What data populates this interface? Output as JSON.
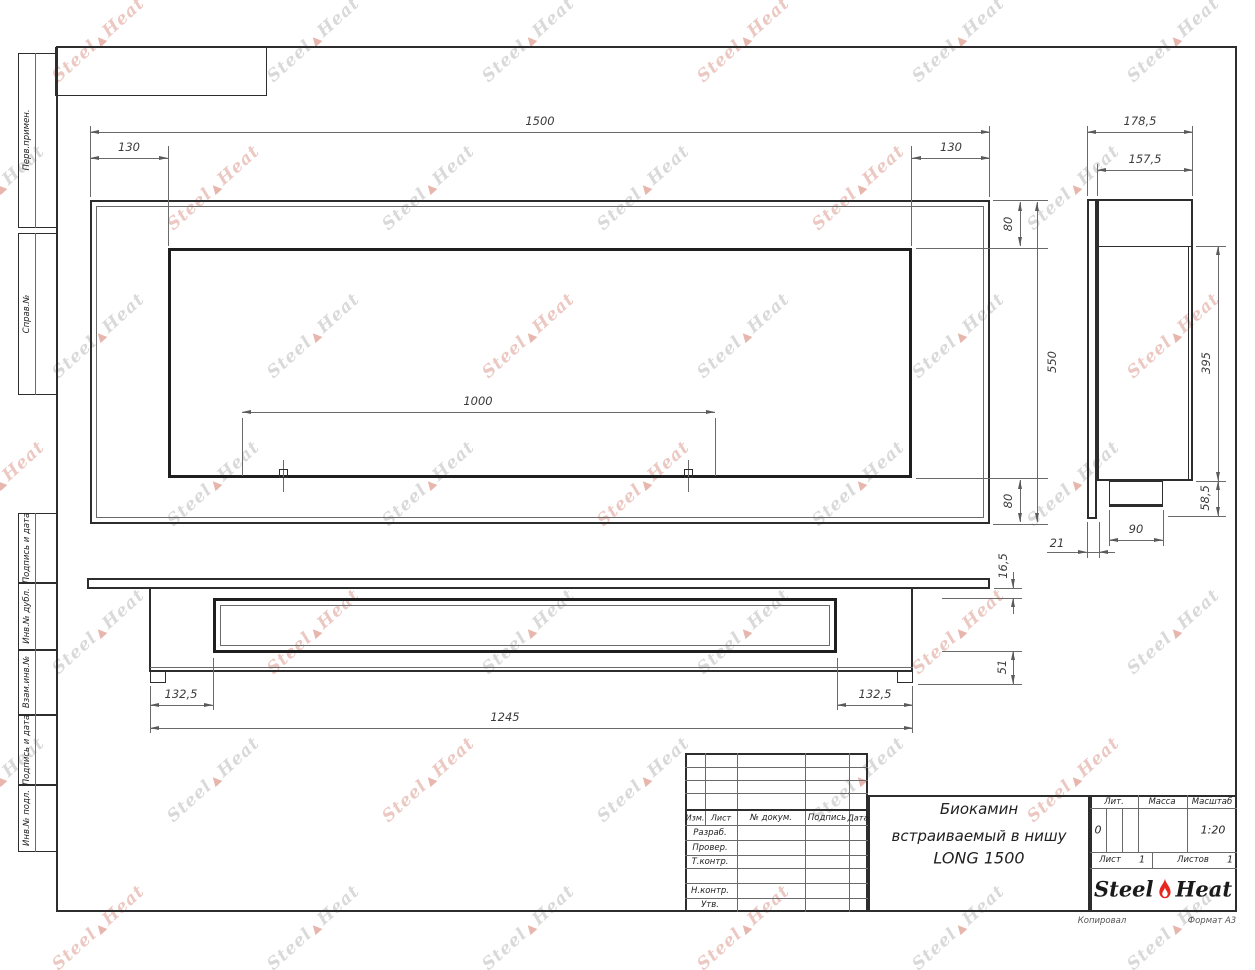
{
  "document": {
    "type": "engineering-drawing",
    "standard": "GOST title block",
    "title_line1": "Биокамин",
    "title_line2": "встраиваемый в нишу",
    "title_line3": "LONG 1500"
  },
  "sidebar": {
    "items": [
      "Перв.примен.",
      "Справ.№",
      "Подпись и дата",
      "Инв.№ дубл.",
      "Взам.инв.№",
      "Подпись и дата",
      "Инв.№ подл."
    ]
  },
  "title_block": {
    "revision_columns": [
      "Изм.",
      "Лист",
      "№ докум.",
      "Подпись",
      "Дата"
    ],
    "roles": [
      "Разраб.",
      "Провер.",
      "Т.контр.",
      "Н.контр.",
      "Утв."
    ],
    "lit_label": "Лит.",
    "lit_value": "0",
    "mass_label": "Масса",
    "scale_label": "Масштаб",
    "scale_value": "1:20",
    "sheet_label": "Лист",
    "sheet_value": "1",
    "sheets_label": "Листов",
    "sheets_value": "1",
    "brand_word1": "Steel",
    "brand_word2": "Heat",
    "copied_by": "Копировал",
    "format": "Формат А3"
  },
  "views": {
    "front": {
      "dim_total_width": "1500",
      "dim_inset_left": "130",
      "dim_inset_right": "130",
      "dim_top_offset": "80",
      "dim_total_height": "550",
      "dim_bottom_offset": "80",
      "dim_bracket_span": "1000"
    },
    "side": {
      "dim_total_depth": "178,5",
      "dim_body_depth": "157,5",
      "dim_niche_height": "395",
      "dim_bottom_lip": "58,5",
      "dim_burner_width": "90",
      "dim_plate_offset": "21"
    },
    "bottom": {
      "dim_plate_thickness": "16,5",
      "dim_tray_depth": "51",
      "dim_inset_left": "132,5",
      "dim_body_length": "1245",
      "dim_inset_right": "132,5"
    }
  },
  "watermark": {
    "word1": "Steel",
    "word2": "Heat"
  },
  "colors": {
    "flame_red": "#e8251f",
    "line_dark": "#2d2d2d",
    "dim_gray": "#5a5a5a"
  }
}
